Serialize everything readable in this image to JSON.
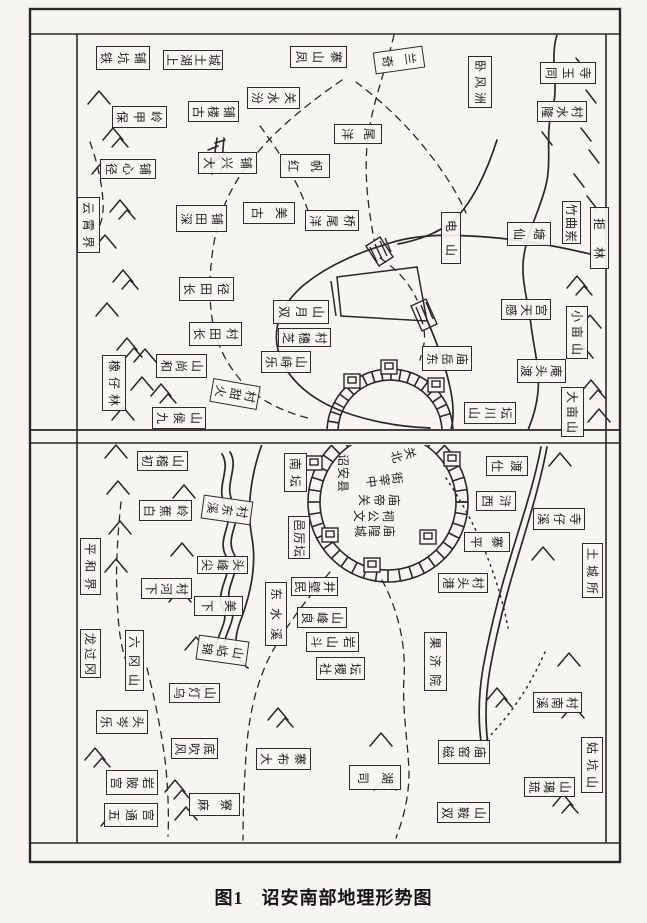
{
  "figure": {
    "caption_number": "图1",
    "caption_title": "诏安南部地理形势图"
  },
  "colors": {
    "paper": "#f7f5f0",
    "ink": "#2b2721"
  },
  "labels": [
    {
      "n": "map-label-tiekengpu",
      "t": "铁坑铺",
      "x": 96,
      "y": 46,
      "w": 54,
      "h": 24,
      "o": "h"
    },
    {
      "n": "map-label-shanghutucheng",
      "t": "上湖土城",
      "x": 163,
      "y": 50,
      "w": 60,
      "h": 20,
      "o": "h"
    },
    {
      "n": "map-label-fengshanzhai",
      "t": "凤山寨",
      "x": 290,
      "y": 46,
      "w": 57,
      "h": 22,
      "o": "h"
    },
    {
      "n": "map-label-qilan",
      "t": "奇兰",
      "x": 374,
      "y": 49,
      "w": 50,
      "h": 22,
      "o": "h",
      "r": -8
    },
    {
      "n": "map-label-wofengzhou",
      "t": "卧风洲",
      "x": 468,
      "y": 56,
      "w": 24,
      "h": 52,
      "o": "v"
    },
    {
      "n": "map-label-tongyusi",
      "t": "同玉寺",
      "x": 540,
      "y": 62,
      "w": 56,
      "h": 22,
      "o": "h"
    },
    {
      "n": "map-label-longshuicun",
      "t": "隆水村",
      "x": 537,
      "y": 101,
      "w": 50,
      "h": 21,
      "o": "h"
    },
    {
      "n": "map-label-fenshuiguan",
      "t": "汾水关",
      "x": 247,
      "y": 87,
      "w": 53,
      "h": 22,
      "o": "h"
    },
    {
      "n": "map-label-guloupu",
      "t": "古楼铺",
      "x": 188,
      "y": 101,
      "w": 51,
      "h": 21,
      "o": "h"
    },
    {
      "n": "map-label-baojialing",
      "t": "保甲岭",
      "x": 112,
      "y": 106,
      "w": 55,
      "h": 22,
      "o": "h"
    },
    {
      "n": "map-label-daxingpu",
      "t": "大兴铺",
      "x": 198,
      "y": 152,
      "w": 59,
      "h": 22,
      "o": "h"
    },
    {
      "n": "map-label-jingxinpu",
      "t": "径心铺",
      "x": 100,
      "y": 159,
      "w": 56,
      "h": 20,
      "o": "h"
    },
    {
      "n": "map-label-hongfan",
      "t": "红帆",
      "x": 280,
      "y": 154,
      "w": 50,
      "h": 24,
      "o": "h"
    },
    {
      "n": "map-label-yangwei",
      "t": "洋尾",
      "x": 334,
      "y": 124,
      "w": 48,
      "h": 20,
      "o": "h"
    },
    {
      "n": "map-label-gumei",
      "t": "古美",
      "x": 243,
      "y": 202,
      "w": 52,
      "h": 22,
      "o": "h"
    },
    {
      "n": "map-label-yangweiqiao",
      "t": "洋尾桥",
      "x": 305,
      "y": 210,
      "w": 54,
      "h": 21,
      "o": "h"
    },
    {
      "n": "map-label-shentianpu",
      "t": "深田铺",
      "x": 176,
      "y": 205,
      "w": 51,
      "h": 27,
      "o": "h"
    },
    {
      "n": "map-label-yunxiaojie",
      "t": "云霄界",
      "x": 77,
      "y": 197,
      "w": 23,
      "h": 56,
      "o": "v"
    },
    {
      "n": "map-label-dianshan",
      "t": "电山",
      "x": 441,
      "y": 212,
      "w": 20,
      "h": 52,
      "o": "v"
    },
    {
      "n": "map-label-xiantang",
      "t": "仙塘",
      "x": 507,
      "y": 222,
      "w": 44,
      "h": 24,
      "o": "h"
    },
    {
      "n": "map-label-zhuqudong",
      "t": "竹曲岽",
      "x": 562,
      "y": 201,
      "w": 19,
      "h": 43,
      "o": "v"
    },
    {
      "n": "map-label-julin",
      "t": "拒林",
      "x": 590,
      "y": 207,
      "w": 19,
      "h": 62,
      "o": "v"
    },
    {
      "n": "map-label-changtianjing",
      "t": "长田径",
      "x": 179,
      "y": 277,
      "w": 55,
      "h": 24,
      "o": "h"
    },
    {
      "n": "map-label-changtiancun",
      "t": "长田村",
      "x": 189,
      "y": 322,
      "w": 53,
      "h": 24,
      "o": "h"
    },
    {
      "n": "map-label-shuangyueshan",
      "t": "双月山",
      "x": 273,
      "y": 300,
      "w": 56,
      "h": 24,
      "o": "h"
    },
    {
      "n": "map-label-zhisuicun",
      "t": "芝穗村",
      "x": 278,
      "y": 328,
      "w": 53,
      "h": 19,
      "o": "h"
    },
    {
      "n": "map-label-lezhishan",
      "t": "乐峙山",
      "x": 261,
      "y": 351,
      "w": 50,
      "h": 22,
      "o": "h"
    },
    {
      "n": "map-label-huotiancun",
      "t": "火甜村",
      "x": 211,
      "y": 382,
      "w": 48,
      "h": 24,
      "o": "h",
      "r": 10
    },
    {
      "n": "map-label-heshangshan",
      "t": "和尚山",
      "x": 156,
      "y": 354,
      "w": 51,
      "h": 24,
      "o": "h"
    },
    {
      "n": "map-label-xiangzailin",
      "t": "橡仔林",
      "x": 102,
      "y": 355,
      "w": 24,
      "h": 56,
      "o": "v"
    },
    {
      "n": "map-label-jiuhoushan",
      "t": "九侯山",
      "x": 152,
      "y": 407,
      "w": 54,
      "h": 22,
      "o": "h"
    },
    {
      "n": "map-label-dongyuemiao",
      "t": "东岳庙",
      "x": 422,
      "y": 346,
      "w": 50,
      "h": 25,
      "o": "h"
    },
    {
      "n": "map-label-gantiangong",
      "t": "感天宫",
      "x": 501,
      "y": 299,
      "w": 50,
      "h": 21,
      "o": "h"
    },
    {
      "n": "map-label-xiaomushan",
      "t": "小亩山",
      "x": 566,
      "y": 306,
      "w": 22,
      "h": 53,
      "o": "v"
    },
    {
      "n": "map-label-dutouan",
      "t": "渡头庵",
      "x": 517,
      "y": 359,
      "w": 49,
      "h": 24,
      "o": "h"
    },
    {
      "n": "map-label-damushan",
      "t": "大亩山",
      "x": 561,
      "y": 387,
      "w": 23,
      "h": 50,
      "o": "v"
    },
    {
      "n": "map-label-shanchuantan",
      "t": "山川坛",
      "x": 464,
      "y": 402,
      "w": 52,
      "h": 22,
      "o": "h"
    },
    {
      "n": "map-label-chujishan",
      "t": "初稽山",
      "x": 137,
      "y": 451,
      "w": 51,
      "h": 20,
      "o": "h"
    },
    {
      "n": "map-label-baijiaoling",
      "t": "白蕉岭",
      "x": 139,
      "y": 500,
      "w": 53,
      "h": 21,
      "o": "h"
    },
    {
      "n": "map-label-xidongcun",
      "t": "溪东村",
      "x": 202,
      "y": 498,
      "w": 50,
      "h": 24,
      "o": "h",
      "r": 8
    },
    {
      "n": "map-label-pinghejie",
      "t": "平和界",
      "x": 80,
      "y": 538,
      "w": 21,
      "h": 57,
      "o": "v"
    },
    {
      "n": "map-label-jianfengtou",
      "t": "尖峰头",
      "x": 197,
      "y": 556,
      "w": 51,
      "h": 18,
      "o": "h"
    },
    {
      "n": "map-label-xiahecun",
      "t": "下河村",
      "x": 141,
      "y": 578,
      "w": 51,
      "h": 21,
      "o": "h"
    },
    {
      "n": "map-label-xiamei",
      "t": "下美",
      "x": 194,
      "y": 596,
      "w": 49,
      "h": 20,
      "o": "h"
    },
    {
      "n": "map-label-longguogang",
      "t": "龙过冈",
      "x": 80,
      "y": 629,
      "w": 21,
      "h": 49,
      "o": "v"
    },
    {
      "n": "map-label-liugangshan",
      "t": "六冈山",
      "x": 125,
      "y": 630,
      "w": 19,
      "h": 61,
      "o": "v"
    },
    {
      "n": "map-label-jinhushan",
      "t": "锦岵山",
      "x": 197,
      "y": 638,
      "w": 51,
      "h": 25,
      "o": "h",
      "r": 8
    },
    {
      "n": "map-label-wudengshan",
      "t": "乌灯山",
      "x": 169,
      "y": 683,
      "w": 51,
      "h": 20,
      "o": "h"
    },
    {
      "n": "map-label-lecentou",
      "t": "乐岑头",
      "x": 96,
      "y": 710,
      "w": 52,
      "h": 24,
      "o": "h"
    },
    {
      "n": "map-label-fengchuidi",
      "t": "风吹底",
      "x": 171,
      "y": 738,
      "w": 47,
      "h": 21,
      "o": "h"
    },
    {
      "n": "map-label-gongpiyan",
      "t": "宫陂岩",
      "x": 106,
      "y": 770,
      "w": 52,
      "h": 25,
      "o": "h"
    },
    {
      "n": "map-label-wutonggong",
      "t": "五通宫",
      "x": 104,
      "y": 803,
      "w": 54,
      "h": 24,
      "o": "h"
    },
    {
      "n": "map-label-maliao",
      "t": "麻寮",
      "x": 189,
      "y": 793,
      "w": 51,
      "h": 23,
      "o": "h"
    },
    {
      "n": "map-label-nantan",
      "t": "南坛",
      "x": 284,
      "y": 453,
      "w": 23,
      "h": 39,
      "o": "v"
    },
    {
      "n": "map-label-yilitan",
      "t": "邑厉坛",
      "x": 288,
      "y": 516,
      "w": 22,
      "h": 43,
      "o": "v"
    },
    {
      "n": "map-label-dongshuixi",
      "t": "东水溪",
      "x": 265,
      "y": 582,
      "w": 22,
      "h": 64,
      "o": "v"
    },
    {
      "n": "map-label-minbijing",
      "t": "民壁井",
      "x": 291,
      "y": 577,
      "w": 47,
      "h": 19,
      "o": "h"
    },
    {
      "n": "map-label-liangfengshan",
      "t": "良峰山",
      "x": 297,
      "y": 607,
      "w": 50,
      "h": 21,
      "o": "h"
    },
    {
      "n": "map-label-doushanyan",
      "t": "斗山岩",
      "x": 306,
      "y": 632,
      "w": 53,
      "h": 20,
      "o": "h"
    },
    {
      "n": "map-label-shejitan",
      "t": "社稷坛",
      "x": 316,
      "y": 657,
      "w": 49,
      "h": 23,
      "o": "h"
    },
    {
      "n": "map-label-dabuzhai",
      "t": "大布寨",
      "x": 256,
      "y": 748,
      "w": 55,
      "h": 22,
      "o": "h"
    },
    {
      "n": "map-label-sihu",
      "t": "司湖",
      "x": 349,
      "y": 765,
      "w": 52,
      "h": 25,
      "o": "h"
    },
    {
      "n": "map-label-guojiyuan",
      "t": "果济院",
      "x": 424,
      "y": 632,
      "w": 23,
      "h": 59,
      "o": "v"
    },
    {
      "n": "map-label-shidu",
      "t": "仕渡",
      "x": 486,
      "y": 456,
      "w": 42,
      "h": 20,
      "o": "h"
    },
    {
      "n": "map-label-xihu",
      "t": "西浒",
      "x": 476,
      "y": 491,
      "w": 40,
      "h": 20,
      "o": "h"
    },
    {
      "n": "map-label-pingzhai",
      "t": "平寨",
      "x": 464,
      "y": 532,
      "w": 46,
      "h": 20,
      "o": "h"
    },
    {
      "n": "map-label-gangtoucun",
      "t": "港头村",
      "x": 438,
      "y": 573,
      "w": 50,
      "h": 20,
      "o": "h"
    },
    {
      "n": "map-label-tuchengsuo",
      "t": "土城所",
      "x": 582,
      "y": 543,
      "w": 21,
      "h": 55,
      "o": "v"
    },
    {
      "n": "map-label-xizaisi",
      "t": "溪仔寺",
      "x": 533,
      "y": 508,
      "w": 52,
      "h": 22,
      "o": "h"
    },
    {
      "n": "map-label-xinancun",
      "t": "溪南村",
      "x": 533,
      "y": 692,
      "w": 49,
      "h": 21,
      "o": "h"
    },
    {
      "n": "map-label-ciyaomiao",
      "t": "磁窑庙",
      "x": 438,
      "y": 740,
      "w": 52,
      "h": 24,
      "o": "h"
    },
    {
      "n": "map-label-liulishan",
      "t": "琉璃山",
      "x": 524,
      "y": 777,
      "w": 51,
      "h": 20,
      "o": "h"
    },
    {
      "n": "map-label-gukengshan",
      "t": "姑坑山",
      "x": 581,
      "y": 737,
      "w": 22,
      "h": 56,
      "o": "v"
    },
    {
      "n": "map-label-shuanganshan",
      "t": "双鞍山",
      "x": 437,
      "y": 802,
      "w": 53,
      "h": 21,
      "o": "h"
    },
    {
      "n": "city-text-zhaoanxian",
      "t": "诏安县",
      "x": 334,
      "y": 452,
      "w": 18,
      "h": 42,
      "o": "v",
      "box": false
    },
    {
      "n": "city-text-beiguan",
      "t": "北关",
      "x": 388,
      "y": 448,
      "w": 30,
      "h": 14,
      "o": "h",
      "r": -15,
      "box": false
    },
    {
      "n": "city-text-zhongzaijie",
      "t": "中宰街",
      "x": 363,
      "y": 472,
      "w": 42,
      "h": 16,
      "o": "h",
      "r": -8,
      "box": false
    },
    {
      "n": "city-text-guandimiao",
      "t": "关帝庙",
      "x": 356,
      "y": 492,
      "w": 46,
      "h": 16,
      "o": "h",
      "box": false
    },
    {
      "n": "city-text-wengongci",
      "t": "文公祠",
      "x": 351,
      "y": 508,
      "w": 45,
      "h": 15,
      "o": "h",
      "box": false
    },
    {
      "n": "city-text-chenghuangmiao",
      "t": "城隍庙",
      "x": 352,
      "y": 523,
      "w": 45,
      "h": 15,
      "o": "h",
      "box": false
    }
  ]
}
